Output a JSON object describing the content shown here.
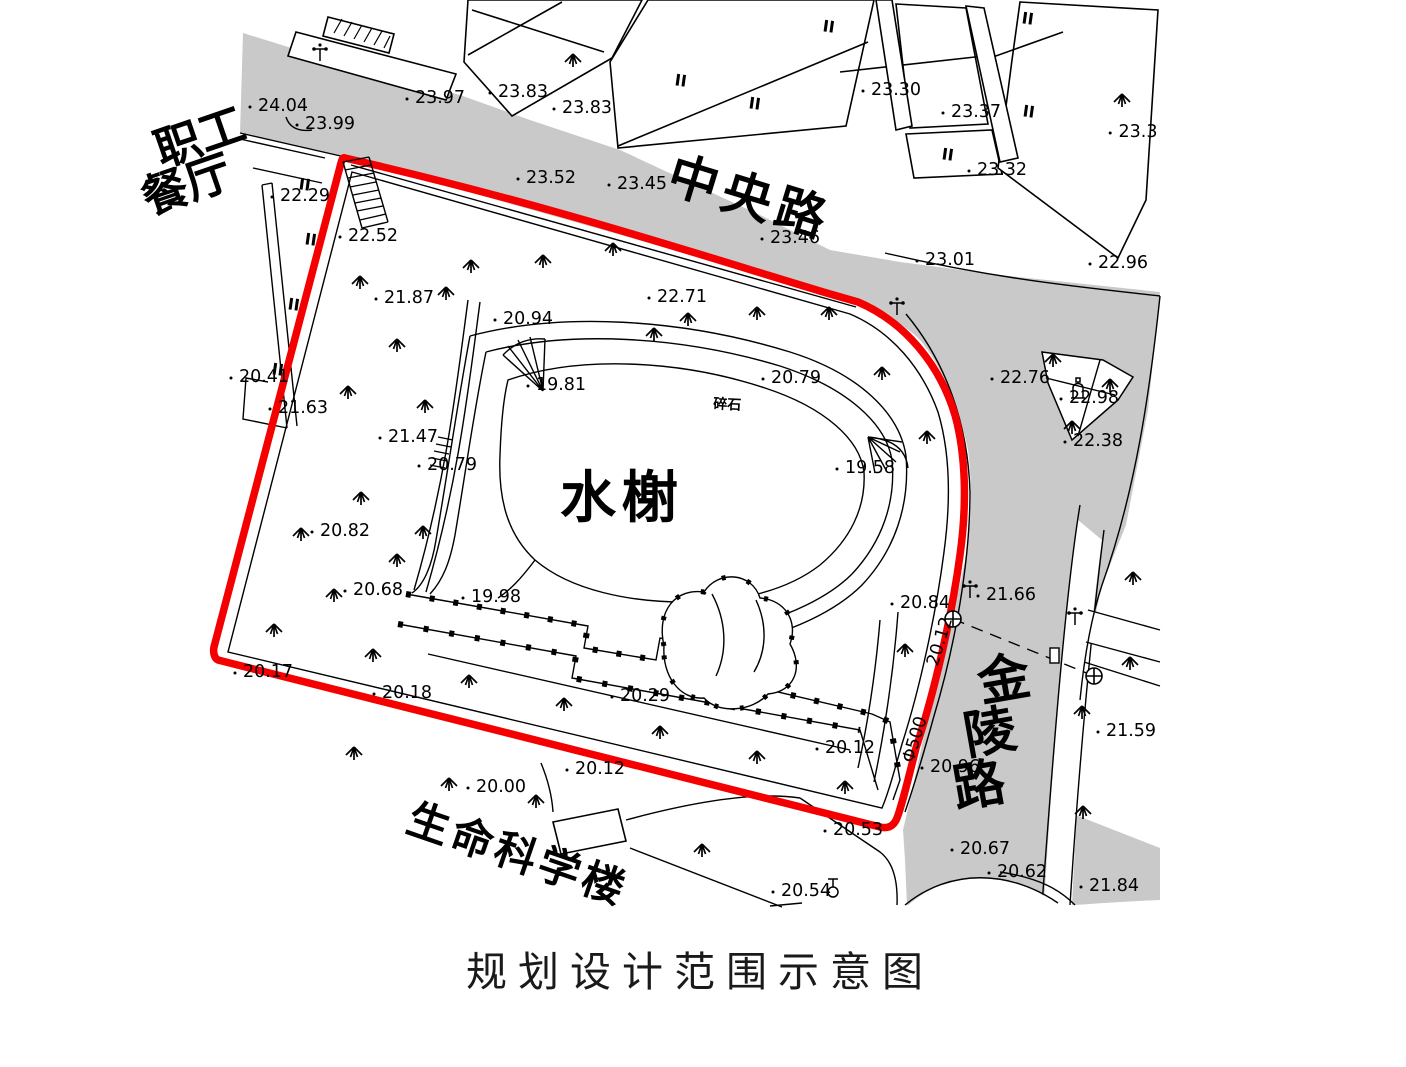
{
  "title": "规划设计范围示意图",
  "colors": {
    "boundary": "#f40000",
    "road_fill": "#c9c9c9",
    "line": "#000000",
    "background": "#ffffff"
  },
  "legend": {
    "boundary_meaning": "规划设计范围"
  },
  "place_labels": [
    {
      "text": "职工",
      "x": 205,
      "y": 152,
      "rot": -19,
      "size": 46,
      "weight": "bold"
    },
    {
      "text": "餐厅",
      "x": 192,
      "y": 200,
      "rot": -19,
      "size": 46,
      "weight": "bold"
    },
    {
      "text": "中央路",
      "x": 745,
      "y": 214,
      "rot": 17,
      "size": 50,
      "weight": "bold",
      "ls": 6
    },
    {
      "text": "金",
      "x": 1007,
      "y": 697,
      "rot": -10,
      "size": 52,
      "weight": "bold"
    },
    {
      "text": "陵",
      "x": 993,
      "y": 750,
      "rot": -10,
      "size": 52,
      "weight": "bold"
    },
    {
      "text": "路",
      "x": 982,
      "y": 803,
      "rot": -10,
      "size": 52,
      "weight": "bold"
    },
    {
      "text": "生命科学楼",
      "x": 513,
      "y": 868,
      "rot": 19,
      "size": 42,
      "weight": "bold",
      "ls": 4
    },
    {
      "text": "水榭",
      "x": 622,
      "y": 517,
      "rot": 0,
      "size": 56,
      "weight": "bold",
      "ls": 6
    },
    {
      "text": "碎石",
      "x": 727,
      "y": 409,
      "rot": 3,
      "size": 14,
      "weight": "bold"
    }
  ],
  "elevation_labels": [
    {
      "t": "24.04",
      "x": 283,
      "y": 111
    },
    {
      "t": "23.99",
      "x": 330,
      "y": 129
    },
    {
      "t": "23.97",
      "x": 440,
      "y": 103
    },
    {
      "t": "23.83",
      "x": 523,
      "y": 97
    },
    {
      "t": "23.83",
      "x": 587,
      "y": 113
    },
    {
      "t": "23.30",
      "x": 896,
      "y": 95
    },
    {
      "t": "23.37",
      "x": 976,
      "y": 117
    },
    {
      "t": "23.32",
      "x": 1002,
      "y": 175
    },
    {
      "t": "23.3",
      "x": 1138,
      "y": 137
    },
    {
      "t": "23.52",
      "x": 551,
      "y": 183
    },
    {
      "t": "23.45",
      "x": 642,
      "y": 189
    },
    {
      "t": "23.46",
      "x": 795,
      "y": 243
    },
    {
      "t": "23.01",
      "x": 950,
      "y": 265
    },
    {
      "t": "22.96",
      "x": 1123,
      "y": 268
    },
    {
      "t": "22.76",
      "x": 1025,
      "y": 383
    },
    {
      "t": "22.98",
      "x": 1094,
      "y": 403
    },
    {
      "t": "22.38",
      "x": 1098,
      "y": 446
    },
    {
      "t": "22.29",
      "x": 305,
      "y": 201
    },
    {
      "t": "22.52",
      "x": 373,
      "y": 241
    },
    {
      "t": "21.87",
      "x": 409,
      "y": 303
    },
    {
      "t": "22.71",
      "x": 682,
      "y": 302
    },
    {
      "t": "20.94",
      "x": 528,
      "y": 324
    },
    {
      "t": "19.81",
      "x": 561,
      "y": 390
    },
    {
      "t": "20.79",
      "x": 796,
      "y": 383
    },
    {
      "t": "19.58",
      "x": 870,
      "y": 473
    },
    {
      "t": "21.63",
      "x": 303,
      "y": 413
    },
    {
      "t": "21.47",
      "x": 413,
      "y": 442
    },
    {
      "t": "20.79",
      "x": 452,
      "y": 470
    },
    {
      "t": "20.41",
      "x": 264,
      "y": 382
    },
    {
      "t": "20.82",
      "x": 345,
      "y": 536
    },
    {
      "t": "20.68",
      "x": 378,
      "y": 595
    },
    {
      "t": "19.98",
      "x": 496,
      "y": 602
    },
    {
      "t": "20.17",
      "x": 268,
      "y": 677
    },
    {
      "t": "20.18",
      "x": 407,
      "y": 698
    },
    {
      "t": "20.29",
      "x": 645,
      "y": 701
    },
    {
      "t": "20.12",
      "x": 850,
      "y": 753
    },
    {
      "t": "20.12",
      "x": 600,
      "y": 774
    },
    {
      "t": "20.00",
      "x": 501,
      "y": 792
    },
    {
      "t": "20.53",
      "x": 858,
      "y": 835
    },
    {
      "t": "20.54",
      "x": 806,
      "y": 896
    },
    {
      "t": "20.84",
      "x": 925,
      "y": 608
    },
    {
      "t": "20.96",
      "x": 955,
      "y": 772
    },
    {
      "t": "21.66",
      "x": 1011,
      "y": 600
    },
    {
      "t": "21.59",
      "x": 1131,
      "y": 736
    },
    {
      "t": "20.67",
      "x": 985,
      "y": 854
    },
    {
      "t": "20.62",
      "x": 1022,
      "y": 877
    },
    {
      "t": "21.84",
      "x": 1114,
      "y": 891
    },
    {
      "t": "20.12",
      "x": 945,
      "y": 643,
      "r": -73
    },
    {
      "t": "Φ500",
      "x": 920,
      "y": 741,
      "r": -73
    }
  ],
  "storey_marks": [
    {
      "t": "II",
      "x": 304,
      "y": 190
    },
    {
      "t": "II",
      "x": 310,
      "y": 245
    },
    {
      "t": "II",
      "x": 293,
      "y": 310
    },
    {
      "t": "II",
      "x": 277,
      "y": 375
    },
    {
      "t": "II",
      "x": 680,
      "y": 86
    },
    {
      "t": "II",
      "x": 754,
      "y": 109
    },
    {
      "t": "II",
      "x": 828,
      "y": 32
    },
    {
      "t": "II",
      "x": 947,
      "y": 160
    },
    {
      "t": "II",
      "x": 1028,
      "y": 117
    },
    {
      "t": "II",
      "x": 1027,
      "y": 24
    }
  ],
  "symbols": {
    "trees": [
      [
        573,
        65
      ],
      [
        1122,
        105
      ],
      [
        471,
        271
      ],
      [
        543,
        266
      ],
      [
        613,
        254
      ],
      [
        360,
        287
      ],
      [
        446,
        298
      ],
      [
        397,
        350
      ],
      [
        348,
        397
      ],
      [
        425,
        411
      ],
      [
        654,
        339
      ],
      [
        688,
        324
      ],
      [
        757,
        318
      ],
      [
        829,
        318
      ],
      [
        882,
        378
      ],
      [
        927,
        442
      ],
      [
        1053,
        365
      ],
      [
        1110,
        390
      ],
      [
        1072,
        432
      ],
      [
        361,
        503
      ],
      [
        301,
        539
      ],
      [
        423,
        537
      ],
      [
        334,
        600
      ],
      [
        274,
        635
      ],
      [
        397,
        565
      ],
      [
        373,
        660
      ],
      [
        469,
        686
      ],
      [
        564,
        709
      ],
      [
        660,
        737
      ],
      [
        757,
        762
      ],
      [
        845,
        792
      ],
      [
        354,
        758
      ],
      [
        449,
        789
      ],
      [
        536,
        806
      ],
      [
        702,
        855
      ],
      [
        905,
        655
      ],
      [
        1133,
        583
      ],
      [
        1130,
        668
      ],
      [
        1082,
        717
      ],
      [
        1083,
        817
      ]
    ],
    "lamps": [
      [
        320,
        53
      ],
      [
        897,
        307
      ],
      [
        970,
        590
      ],
      [
        1075,
        617
      ]
    ],
    "manholes": [
      [
        953,
        619
      ],
      [
        1094,
        676
      ]
    ],
    "monuments": [
      [
        1078,
        390
      ]
    ],
    "street_lamps": [
      [
        833,
        888
      ]
    ]
  }
}
